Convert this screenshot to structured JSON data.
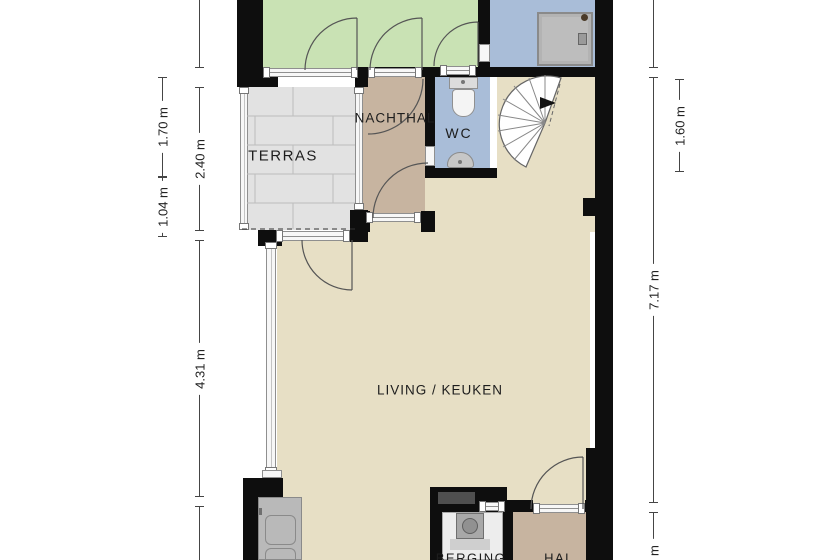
{
  "plan": {
    "room_labels": {
      "terras": "TERRAS",
      "nachthal": "NACHTHAL",
      "wc": "WC",
      "living": "LIVING / KEUKEN",
      "berging": "BERGING",
      "hal": "HAL"
    },
    "dimensions": {
      "left_outer_top": "1.70 m",
      "left_outer_bottom": "1.04 m",
      "left_inner_upper": "2.40 m",
      "left_inner_lower": "4.31 m",
      "right_inner_main": "7.17 m",
      "right_inner_bottom_partial": "7 m",
      "right_outer_top": "1.60 m"
    },
    "colors": {
      "wall": "#0e0e0e",
      "garden-green": "#c9e2b4",
      "bath-blue": "#a9bdd8",
      "living-beige": "#e7dfc5",
      "terras-grey": "#e2e2e2",
      "hall-tan": "#c7b4a0",
      "berging-grey": "#ededed",
      "frame-fill": "#f7f7f7",
      "frame-line": "#8f8f8f",
      "arc-line": "#555555"
    }
  }
}
